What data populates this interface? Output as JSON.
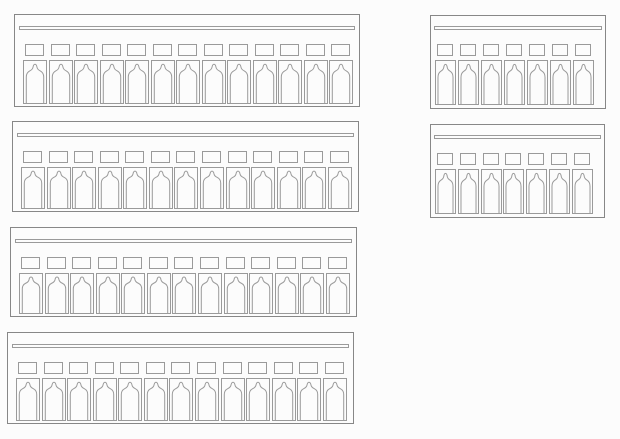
{
  "canvas": {
    "width": 620,
    "height": 439,
    "background": "#fcfcfc"
  },
  "drawing": {
    "line_color": "#878787",
    "inner_line_color": "#9a9a9a",
    "panels": [
      {
        "id": "terminal-strip-13pos-1",
        "positions": 13,
        "size": "large",
        "x": 14,
        "y": 14,
        "width": 346,
        "height": 93
      },
      {
        "id": "terminal-strip-13pos-2",
        "positions": 13,
        "size": "large",
        "x": 12,
        "y": 121,
        "width": 347,
        "height": 91
      },
      {
        "id": "terminal-strip-13pos-3",
        "positions": 13,
        "size": "large",
        "x": 10,
        "y": 227,
        "width": 347,
        "height": 90
      },
      {
        "id": "terminal-strip-13pos-4",
        "positions": 13,
        "size": "large",
        "x": 7,
        "y": 332,
        "width": 347,
        "height": 92
      },
      {
        "id": "terminal-strip-7pos-1",
        "positions": 7,
        "size": "small",
        "x": 430,
        "y": 15,
        "width": 176,
        "height": 94
      },
      {
        "id": "terminal-strip-7pos-2",
        "positions": 7,
        "size": "small",
        "x": 430,
        "y": 124,
        "width": 175,
        "height": 94
      }
    ],
    "unit_metrics": {
      "large": {
        "cap_w": 19,
        "cap_h": 12,
        "body_w": 24,
        "caps_top": 29,
        "body_gap": 4,
        "pad_left": 8,
        "pad_right": 6,
        "rail_top": 11,
        "rail_h": 4,
        "rail_inset": 4,
        "body_bottom": 2
      },
      "small": {
        "cap_w": 16,
        "cap_h": 12,
        "body_w": 21,
        "caps_top": 28,
        "body_gap": 4,
        "pad_left": 4,
        "pad_right": 11,
        "rail_top": 10,
        "rail_h": 4,
        "rail_inset": 3,
        "body_bottom": 3
      }
    }
  }
}
